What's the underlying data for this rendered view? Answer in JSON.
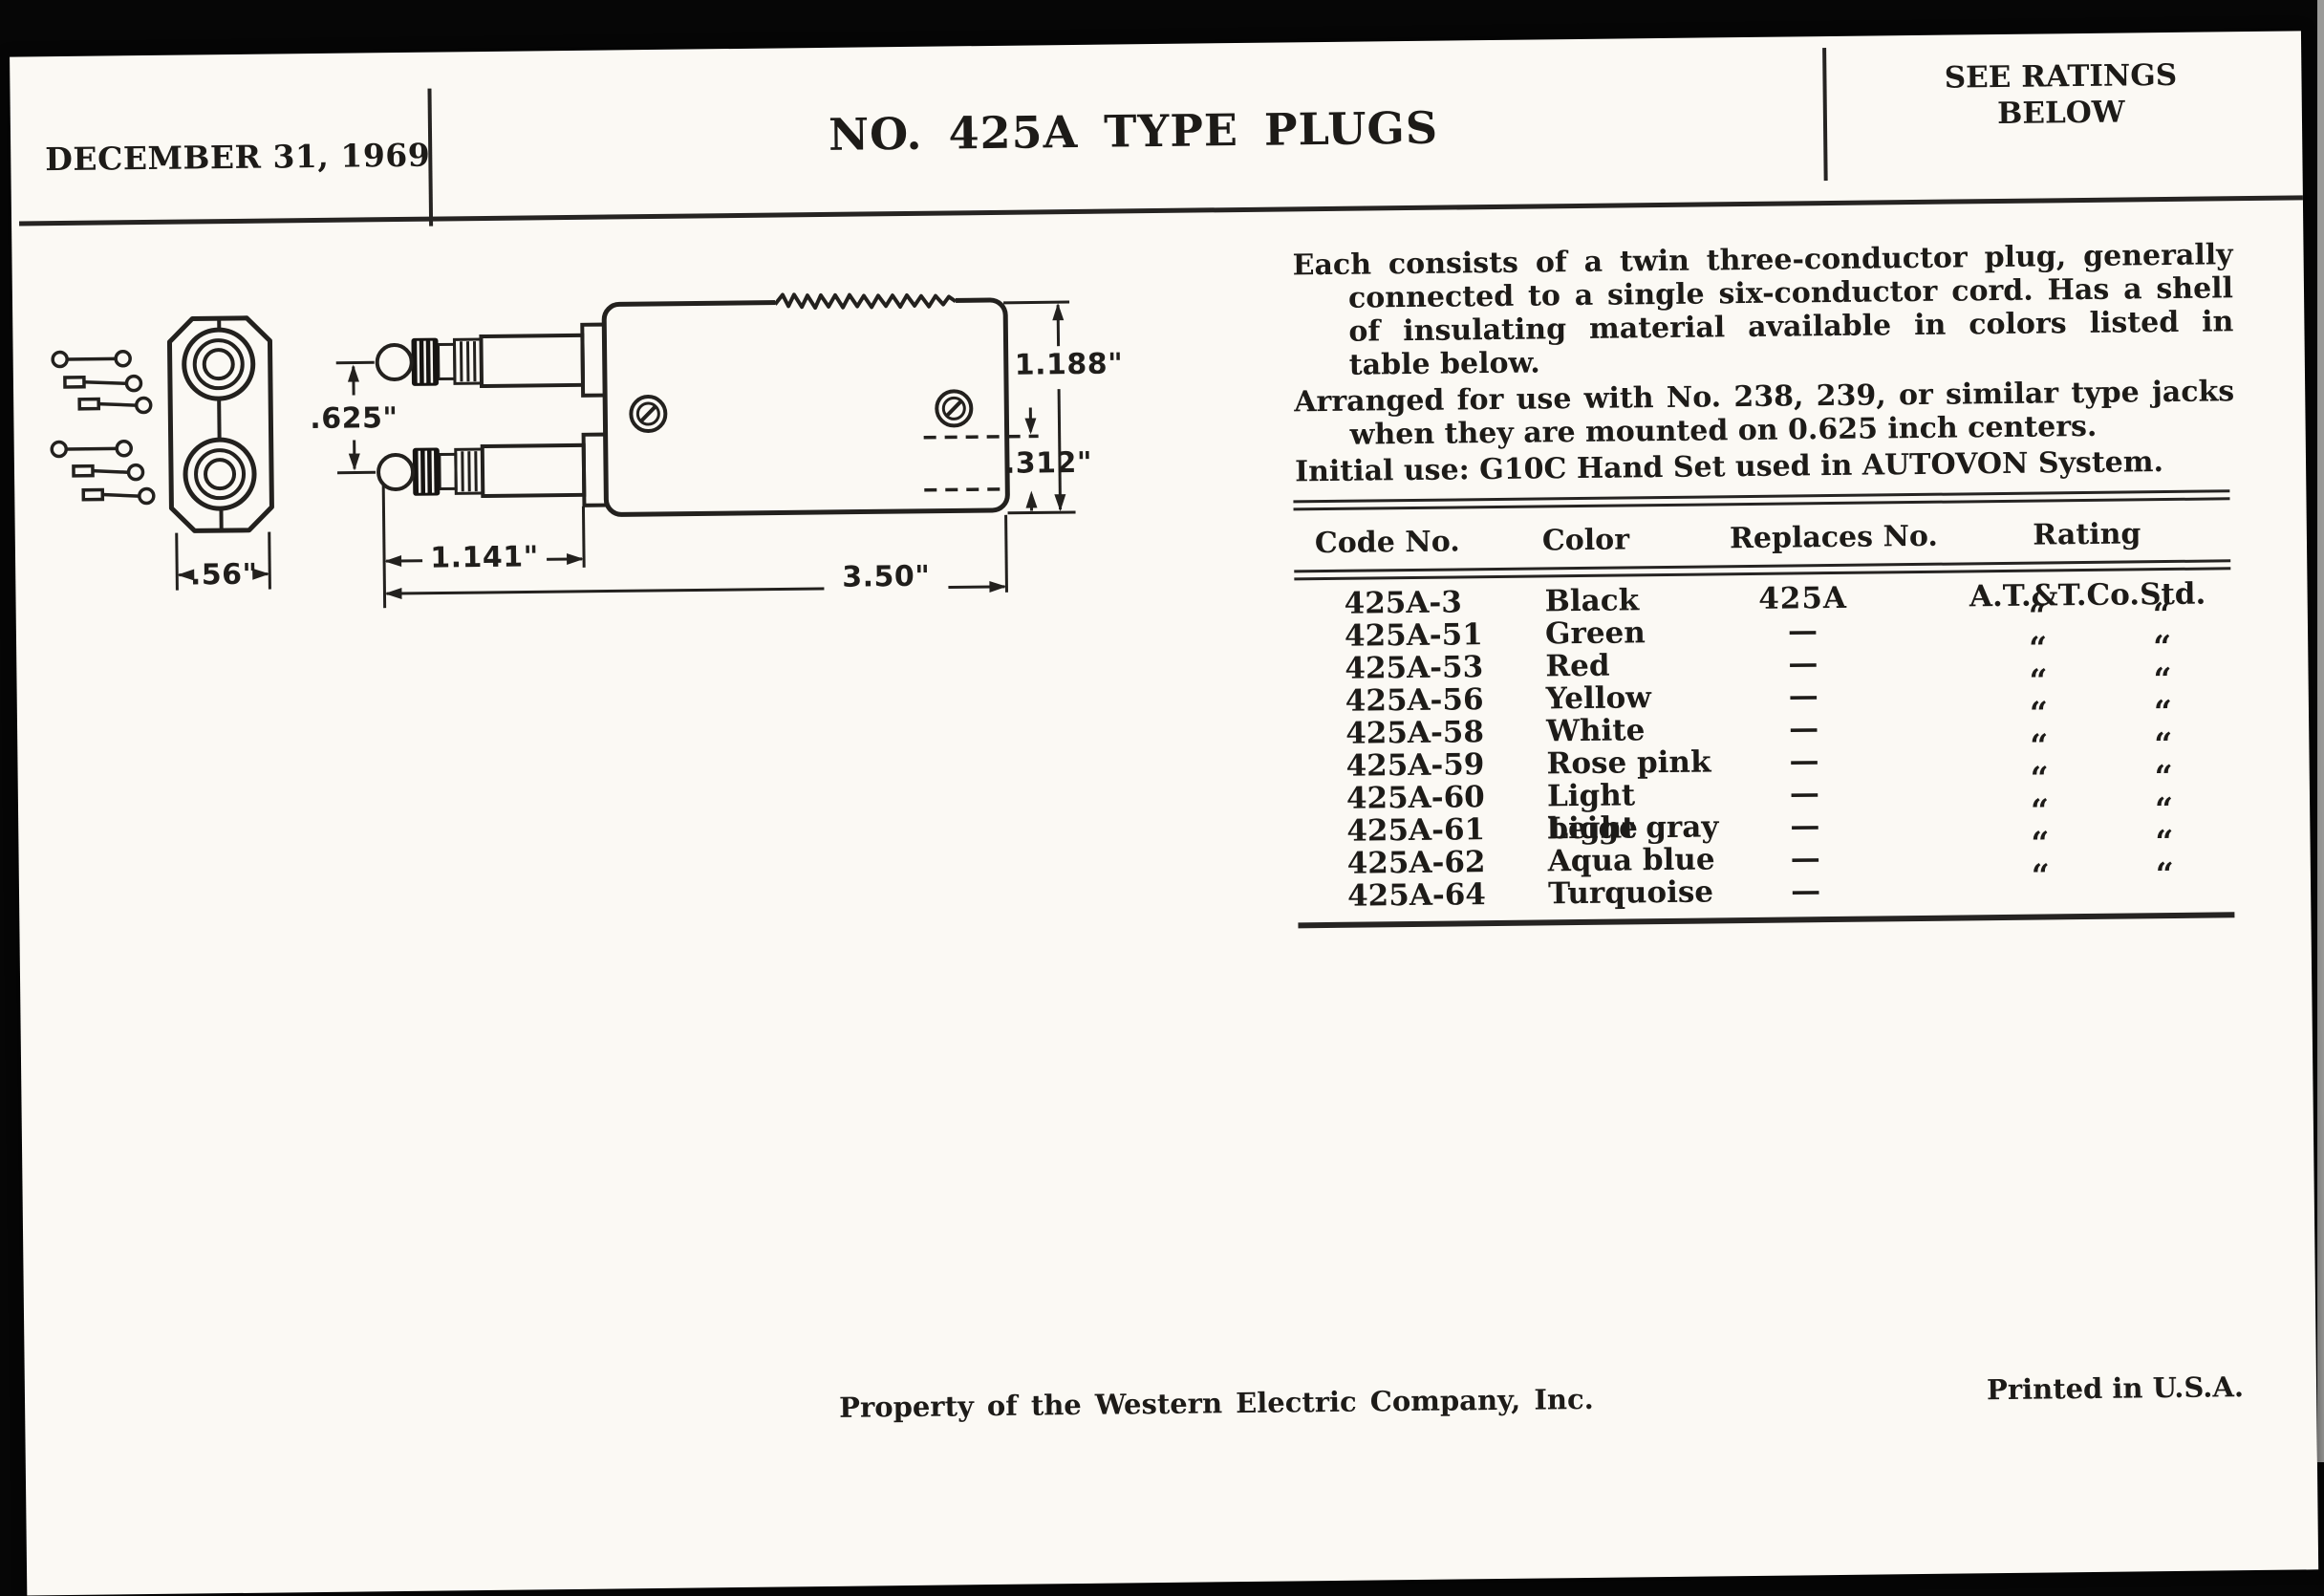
{
  "header": {
    "date": "DECEMBER 31, 1969",
    "title": "NO. 425A TYPE PLUGS",
    "ratings_note": [
      "SEE RATINGS",
      "BELOW"
    ]
  },
  "description": {
    "paragraphs": [
      "Each consists of a twin three-conductor plug, generally connected to a single six-conductor cord.  Has a shell of insulating material available in colors listed in table below.",
      "Arranged for use with No. 238, 239, or similar type jacks when they are mounted on 0.625 inch centers.",
      "Initial use:  G10C Hand Set used in AUTOVON System."
    ]
  },
  "diagram": {
    "dimensions": {
      "end_width": ".56\"",
      "tip_spacing": ".625\"",
      "tip_length": "1.141\"",
      "overall_length": "3.50\"",
      "body_height": "1.188\"",
      "lower_offset": ".312\""
    }
  },
  "table": {
    "columns": [
      "Code No.",
      "Color",
      "Replaces No.",
      "Rating"
    ],
    "ditto_mark": "“",
    "rows": [
      {
        "code": "425A-3",
        "color": "Black",
        "replaces": "425A",
        "rating": "A.T.&T.Co.Std.",
        "ditto": false
      },
      {
        "code": "425A-51",
        "color": "Green",
        "replaces": "—",
        "rating": "“ “",
        "ditto": true
      },
      {
        "code": "425A-53",
        "color": "Red",
        "replaces": "—",
        "rating": "“ “",
        "ditto": true
      },
      {
        "code": "425A-56",
        "color": "Yellow",
        "replaces": "—",
        "rating": "“ “",
        "ditto": true
      },
      {
        "code": "425A-58",
        "color": "White",
        "replaces": "—",
        "rating": "“ “",
        "ditto": true
      },
      {
        "code": "425A-59",
        "color": "Rose pink",
        "replaces": "—",
        "rating": "“ “",
        "ditto": true
      },
      {
        "code": "425A-60",
        "color": "Light beige",
        "replaces": "—",
        "rating": "“ “",
        "ditto": true
      },
      {
        "code": "425A-61",
        "color": "Light gray",
        "replaces": "—",
        "rating": "“ “",
        "ditto": true
      },
      {
        "code": "425A-62",
        "color": "Aqua blue",
        "replaces": "—",
        "rating": "“ “",
        "ditto": true
      },
      {
        "code": "425A-64",
        "color": "Turquoise",
        "replaces": "—",
        "rating": "“ “",
        "ditto": true
      }
    ]
  },
  "footer": {
    "property_note": "Property of the Western Electric Company, Inc.",
    "printed_note": "Printed in U.S.A."
  }
}
